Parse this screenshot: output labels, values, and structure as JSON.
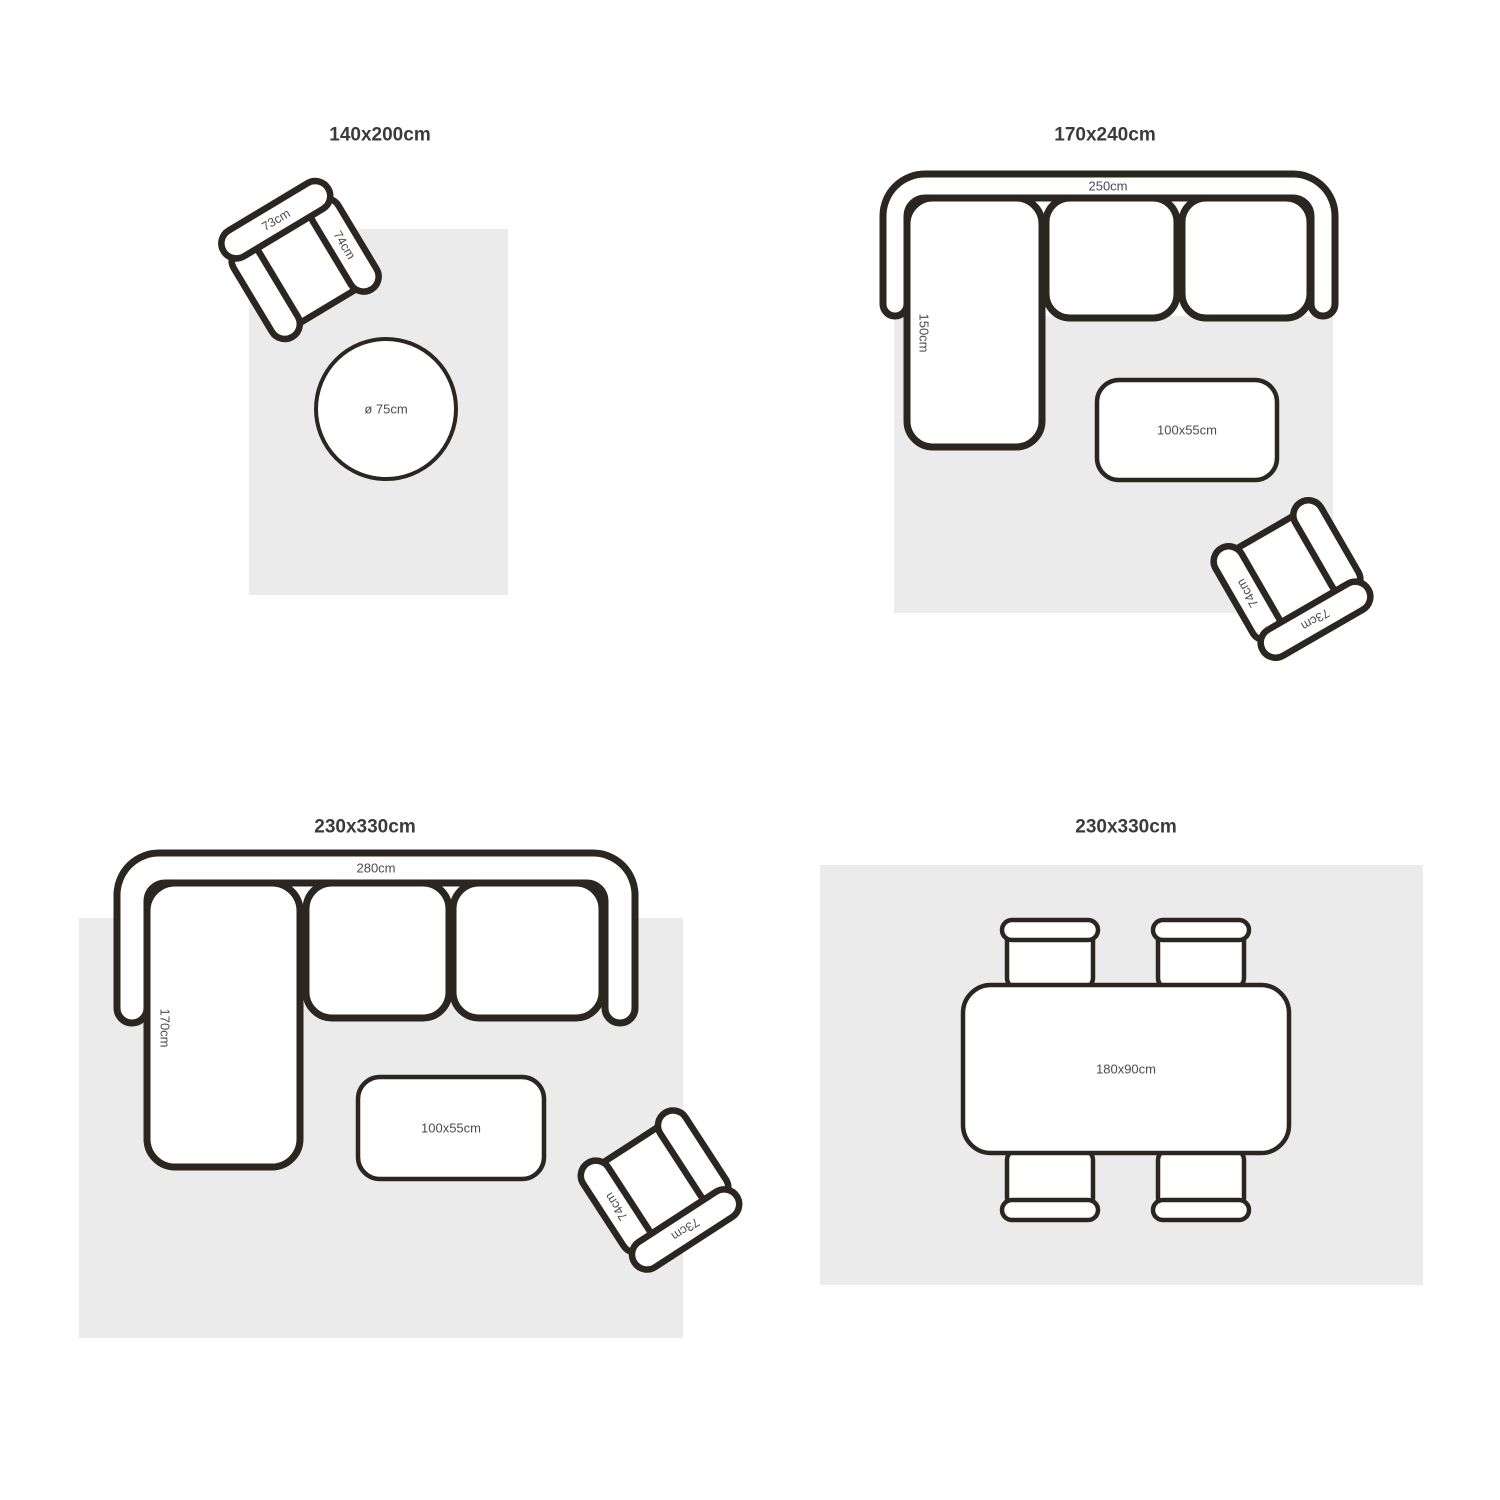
{
  "page": {
    "background": "#ffffff",
    "description_title": "Rug size guide"
  },
  "colors": {
    "rug_fill": "#ebebeb",
    "outline": "#2b2620",
    "title_text": "#3b3b3b",
    "label_text": "#4c4c4c"
  },
  "quadrants": [
    {
      "title": "140x200cm",
      "armchair": {
        "back_label": "73cm",
        "side_label": "74cm"
      },
      "round_table": {
        "label": "ø 75cm"
      }
    },
    {
      "title": "170x240cm",
      "sofa": {
        "width_label": "250cm",
        "depth_label": "150cm"
      },
      "coffee_table": {
        "label": "100x55cm"
      },
      "armchair": {
        "back_label": "73cm",
        "side_label": "74cm"
      }
    },
    {
      "title": "230x330cm",
      "sofa": {
        "width_label": "280cm",
        "depth_label": "170cm"
      },
      "coffee_table": {
        "label": "100x55cm"
      },
      "armchair": {
        "back_label": "73cm",
        "side_label": "74cm"
      }
    },
    {
      "title": "230x330cm",
      "dining_table": {
        "label": "180x90cm"
      }
    }
  ]
}
